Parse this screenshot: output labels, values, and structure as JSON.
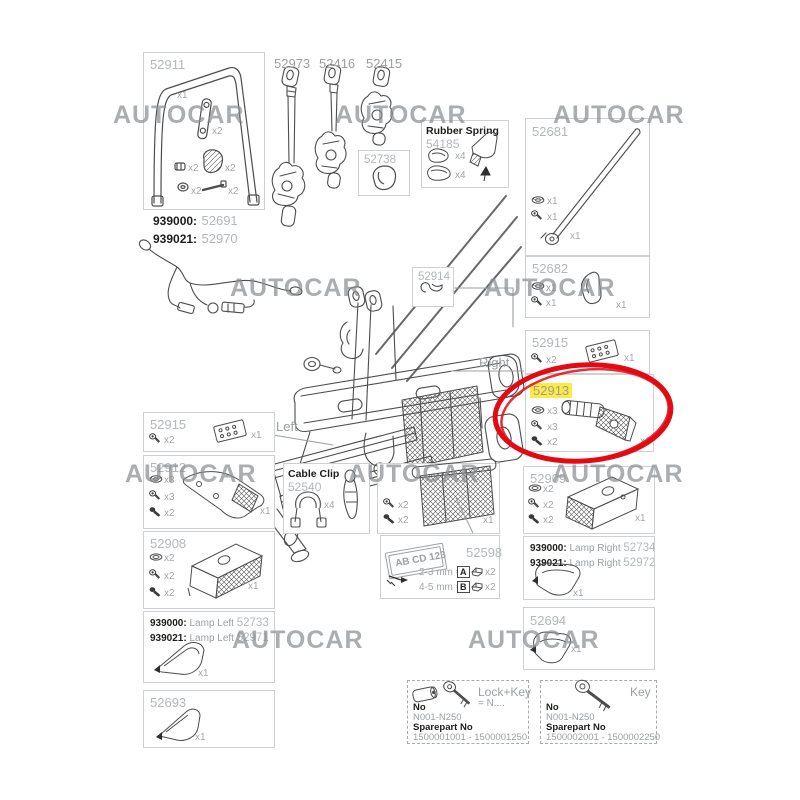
{
  "watermark": {
    "text": "AUTOCAR"
  },
  "assembly": {
    "left_label": "Left",
    "right_label": "Right"
  },
  "p52911": {
    "number": "52911",
    "qty_frame": "x1",
    "qty_lever": "x2",
    "qty_clip": "x2",
    "qty_pad": "x2",
    "qty_nut": "x2",
    "qty_bolt": "x2"
  },
  "harness": {
    "code1": "939000:",
    "num1": "52691",
    "code2": "939021:",
    "num2": "52970"
  },
  "p52973": {
    "number": "52973"
  },
  "p52416": {
    "number": "52416"
  },
  "p52415": {
    "number": "52415"
  },
  "p52738": {
    "number": "52738"
  },
  "rubber_spring": {
    "title": "Rubber Spring",
    "number": "54185",
    "qty_clip1": "x4",
    "qty_clip2": "x4"
  },
  "p52681": {
    "number": "52681",
    "qty_nut": "x1",
    "qty_screw": "x1",
    "qty_bar": "x1"
  },
  "p52682": {
    "number": "52682",
    "qty_nut": "x1",
    "qty_screw": "x1",
    "qty_part": "x1"
  },
  "p52915_right": {
    "number": "52915",
    "qty_screw": "x2",
    "qty_plate": "x1"
  },
  "p52913": {
    "number": "52913",
    "qty_nut": "x3",
    "qty_screw": "x3",
    "qty_bolt": "x2",
    "qty_part": "x1"
  },
  "p52914": {
    "number": "52914"
  },
  "p52915_left": {
    "number": "52915",
    "qty_screw": "x2",
    "qty_plate": "x1"
  },
  "p52912": {
    "number": "52912",
    "qty_nut": "x3",
    "qty_screw": "x3",
    "qty_bolt": "x2",
    "qty_part": "x1"
  },
  "p52908": {
    "number": "52908",
    "qty_washer": "x2",
    "qty_screw": "x2",
    "qty_bolt": "x2",
    "qty_part": "x1"
  },
  "lamp_left": {
    "code1": "939000:",
    "name1": "Lamp Left",
    "num1": "52733",
    "code2": "939021:",
    "name2": "Lamp Left",
    "num2": "52971",
    "qty": "x1"
  },
  "p52693": {
    "number": "52693",
    "qty": "x1"
  },
  "cable_clip": {
    "title": "Cable Clip",
    "number": "52540",
    "qty": "x4"
  },
  "plate_holder": {
    "qty_screw": "x2",
    "qty_bolt": "x2",
    "qty_part": "x1"
  },
  "p52598": {
    "number": "52598",
    "plate_text": "AB CD 123",
    "row_a": "2-3 mm =",
    "letter_a": "A",
    "qty_a": "x2",
    "row_b": "4-5 mm =",
    "letter_b": "B",
    "qty_b": "x2"
  },
  "p52909": {
    "number": "52909",
    "qty_washer": "x2",
    "qty_screw": "x2",
    "qty_bolt": "x2",
    "qty_part": "x1"
  },
  "lamp_right": {
    "code1": "939000:",
    "name1": "Lamp Right",
    "num1": "52734",
    "code2": "939021:",
    "name2": "Lamp Right",
    "num2": "52972",
    "qty": "x1"
  },
  "p52694": {
    "number": "52694",
    "qty": "x1"
  },
  "lock_key": {
    "title": "Lock+Key",
    "equals": "= N....",
    "no_label": "No",
    "no_value": "N001-N250",
    "sp_label": "Sparepart No",
    "sp_value": "1500001001 - 1500001250"
  },
  "key_box": {
    "title": "Key",
    "no_label": "No",
    "no_value": "N001-N250",
    "sp_label": "Sparepart No",
    "sp_value": "1500002001 - 1500002250"
  },
  "colors": {
    "highlight": "#ffe946",
    "circle": "#e30b13",
    "line": "#4d4d4d"
  }
}
